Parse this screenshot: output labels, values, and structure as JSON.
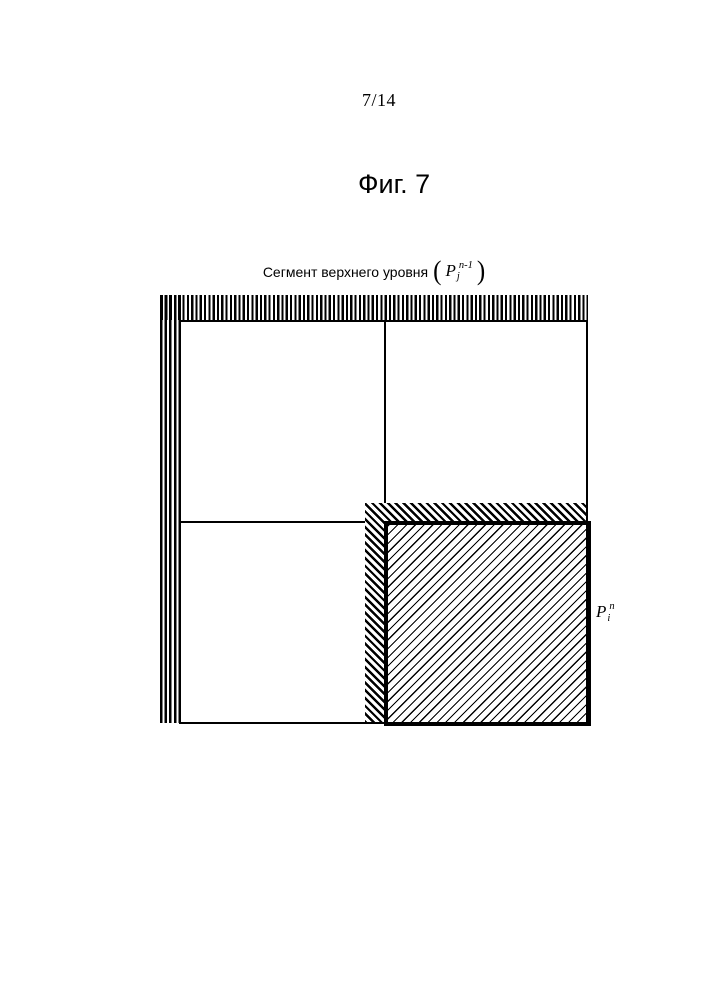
{
  "page": {
    "number": "7/14",
    "figure_title": "Фиг. 7"
  },
  "diagram": {
    "top_label": {
      "text": "Сегмент верхнего уровня",
      "paren_open": "(",
      "symbol": "P",
      "subscript": "j",
      "superscript": "n-1",
      "paren_close": ")"
    },
    "inner_label": {
      "symbol": "P",
      "subscript": "i",
      "superscript": "n"
    },
    "colors": {
      "ink": "#000000",
      "paper": "#ffffff"
    }
  }
}
